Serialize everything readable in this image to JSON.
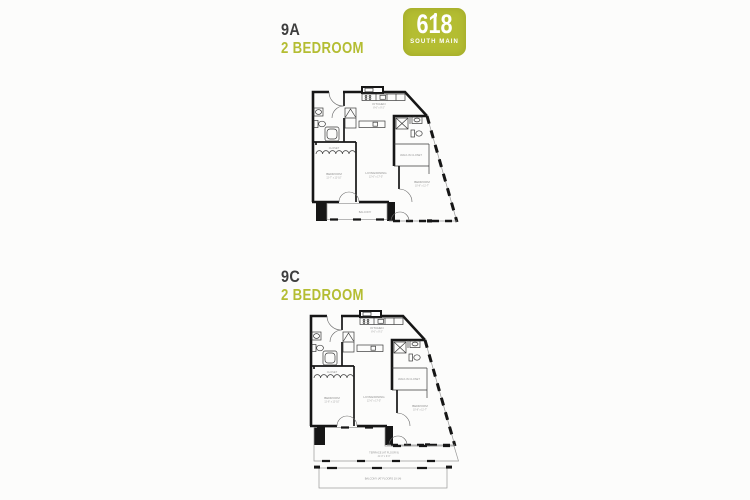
{
  "colors": {
    "accent": "#b4bd32",
    "heading": "#3e3e3e"
  },
  "brand": {
    "logo_number": "618",
    "logo_name": "SOUTH MAIN"
  },
  "plans": [
    {
      "unit": "9A",
      "type": "2 BEDROOM",
      "labels": {
        "kitchen": "KITCHEN",
        "kitchen_dims": "8'-6\" x 9'-2\"",
        "closet": "CLOSET",
        "bedroom1": "BEDROOM",
        "bedroom1_dims": "11'-7\" x 12'-10\"",
        "living": "LIVING/DINING",
        "living_dims": "12'-6\" x 17'-5\"",
        "walkin": "WALK-IN CLOSET",
        "bedroom2": "BEDROOM",
        "bedroom2_dims": "10'-8\" x 11'-7\"",
        "outdoor": "BALCONY"
      }
    },
    {
      "unit": "9C",
      "type": "2 BEDROOM",
      "labels": {
        "kitchen": "KITCHEN",
        "kitchen_dims": "8'-6\" x 9'-2\"",
        "closet": "CLOSET",
        "bedroom1": "BEDROOM",
        "bedroom1_dims": "11'-6\" x 12'-10\"",
        "living": "LIVING/DINING",
        "living_dims": "12'-6\" x 17'-5\"",
        "walkin": "WALK-IN CLOSET",
        "bedroom2": "BEDROOM",
        "bedroom2_dims": "10'-8\" x 11'-7\"",
        "terrace": "TERRACE (AT FLOOR 9)",
        "terrace_dims": "41'-0\" x 9'-6\"",
        "balcony": "BALCONY (AT FLOORS 10-14)"
      }
    }
  ]
}
